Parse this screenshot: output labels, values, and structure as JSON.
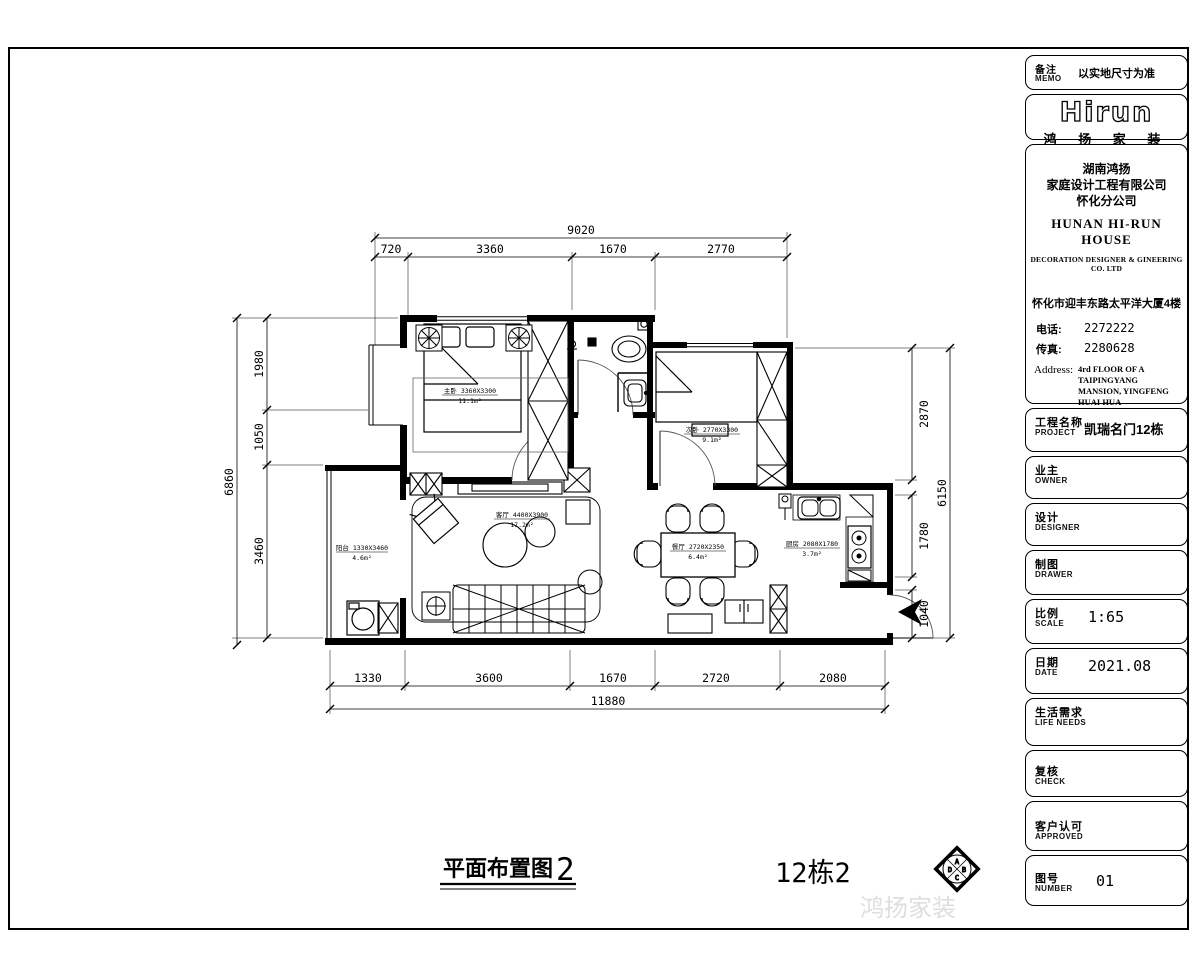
{
  "memo": {
    "cn": "备注",
    "en": "MEMO",
    "value": "以实地尺寸为准"
  },
  "brand": {
    "logo": "Hirun",
    "name": "鸿 扬 家 装"
  },
  "company": {
    "cn1": "湖南鸿扬",
    "cn2": "家庭设计工程有限公司",
    "cn3": "怀化分公司",
    "en1": "HUNAN HI-RUN HOUSE",
    "en2": "DECORATION DESIGNER & GINEERING CO. LTD",
    "addr_cn": "怀化市迎丰东路太平洋大厦4楼",
    "phone_label": "电话:",
    "phone": "2272222",
    "fax_label": "传真:",
    "fax": "2280628",
    "address_label": "Address:",
    "address1": "4rd FLOOR OF A TAIPINGYANG",
    "address2": "MANSION, YINGFENG",
    "address3": "HUAI HUA",
    "tel_label": "Tel:",
    "tel": "2272222",
    "fax2_label": "Fax:",
    "fax2": "2280628"
  },
  "fields": [
    {
      "cn": "工程名称",
      "en": "PROJECT",
      "value": "凯瑞名门12栋"
    },
    {
      "cn": "业主",
      "en": "OWNER",
      "value": ""
    },
    {
      "cn": "设计",
      "en": "DESIGNER",
      "value": ""
    },
    {
      "cn": "制图",
      "en": "DRAWER",
      "value": ""
    },
    {
      "cn": "比例",
      "en": "SCALE",
      "value": "1:65"
    },
    {
      "cn": "日期",
      "en": "DATE",
      "value": "2021.08"
    },
    {
      "cn": "生活需求",
      "en": "LIFE NEEDS",
      "value": ""
    },
    {
      "cn": "复核",
      "en": "CHECK",
      "value": ""
    },
    {
      "cn": "客户认可",
      "en": "APPROVED",
      "value": ""
    },
    {
      "cn": "图号",
      "en": "NUMBER",
      "value": "01"
    }
  ],
  "drawing": {
    "title": "平面布置图",
    "title_suffix": "2",
    "block_label": "12栋2",
    "watermark": "鸿扬家装",
    "stamp": {
      "top": "A",
      "right": "B",
      "bottom": "C",
      "left": "D"
    },
    "dims": {
      "top_overall": "9020",
      "top": [
        "720",
        "3360",
        "1670",
        "2770"
      ],
      "left_overall": "6860",
      "left": [
        "1980",
        "1050",
        "3460"
      ],
      "right_overall": "6150",
      "right": [
        "2870",
        "1780",
        "1040"
      ],
      "bottom_overall": "11880",
      "bottom": [
        "1330",
        "3600",
        "1670",
        "2720",
        "2080"
      ]
    },
    "rooms": [
      {
        "line1": "主卧 3360X3300",
        "line2": "11.1m²"
      },
      {
        "line1": "次卧 2770X3300",
        "line2": "9.1m²"
      },
      {
        "line1": "客厅 4400X3900",
        "line2": "17.2m²"
      },
      {
        "line1": "餐厅 2720X2350",
        "line2": "6.4m²"
      },
      {
        "line1": "厨房 2080X1780",
        "line2": "3.7m²"
      },
      {
        "line1": "阳台 1330X3460",
        "line2": "4.6m²"
      }
    ]
  }
}
